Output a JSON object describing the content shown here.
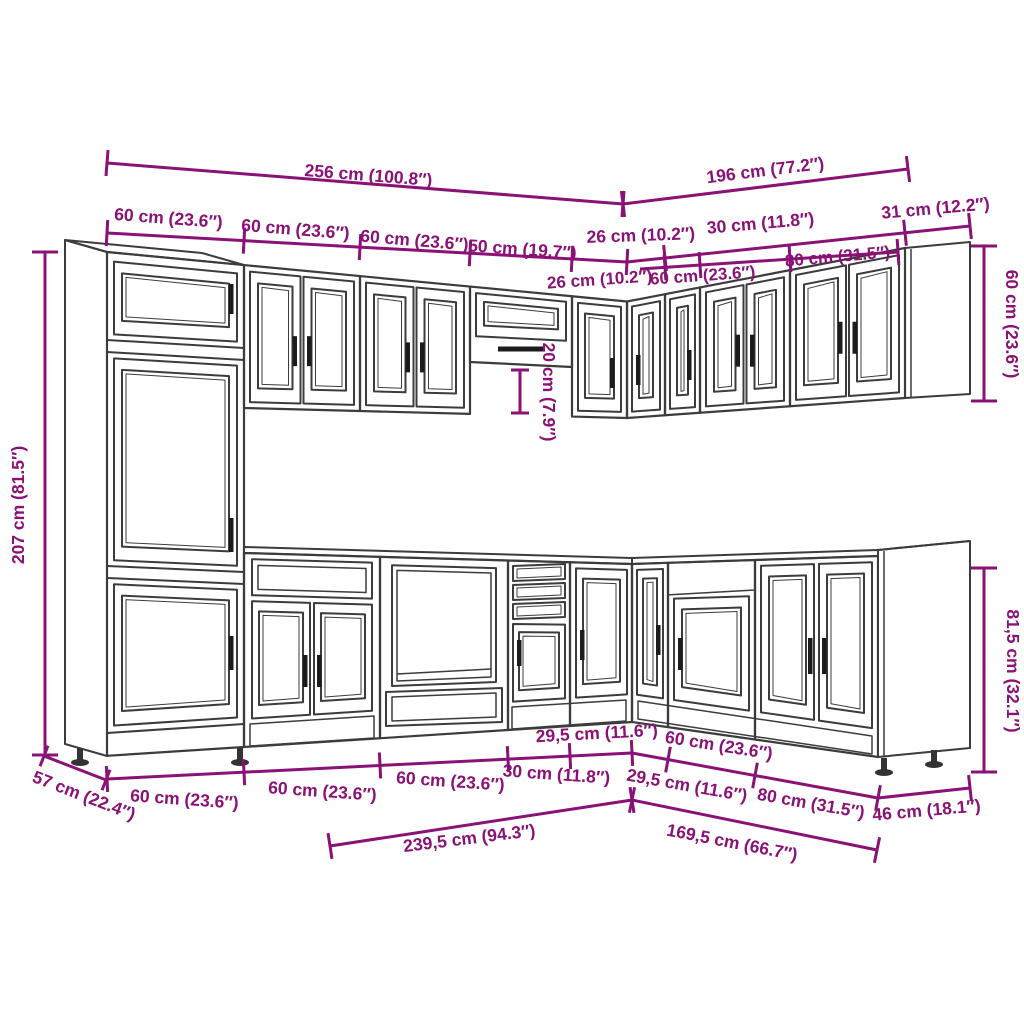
{
  "accent": "#8A1175",
  "line_color": "#3c3c3c",
  "handle_color": "#1c1c1c",
  "dims": {
    "run_left_total": "256 cm (100.8″)",
    "run_right_total": "196 cm (77.2″)",
    "wall_left_1": "60 cm (23.6″)",
    "wall_left_2": "60 cm (23.6″)",
    "wall_left_3": "60 cm (23.6″)",
    "wall_left_4": "50 cm (19.7″)",
    "wall_corner_left": "26 cm (10.2″)",
    "wall_corner_right": "30 cm (11.8″)",
    "wall_depth": "31 cm (12.2″)",
    "wall_right_1": "26 cm (10.2″)",
    "wall_right_2": "60 cm (23.6″)",
    "wall_right_3": "80 cm (31.5″)",
    "tall_height": "207 cm (81.5″)",
    "wall_end_height": "60 cm (23.6″)",
    "hood_gap": "20 cm (7.9″)",
    "base_height": "81,5 cm (32.1″)",
    "base_depth_left": "57 cm (22.4″)",
    "base_left_1": "60 cm (23.6″)",
    "base_left_2": "60 cm (23.6″)",
    "base_left_3": "60 cm (23.6″)",
    "base_left_4": "30 cm (11.8″)",
    "base_corner_left": "29,5 cm (11.6″)",
    "base_corner_right": "29,5 cm (11.6″)",
    "base_right_1": "60 cm (23.6″)",
    "base_right_2": "80 cm (31.5″)",
    "base_depth_right": "46 cm (18.1″)",
    "base_total_left": "239,5 cm (94.3″)",
    "base_total_right": "169,5 cm (66.7″)"
  }
}
